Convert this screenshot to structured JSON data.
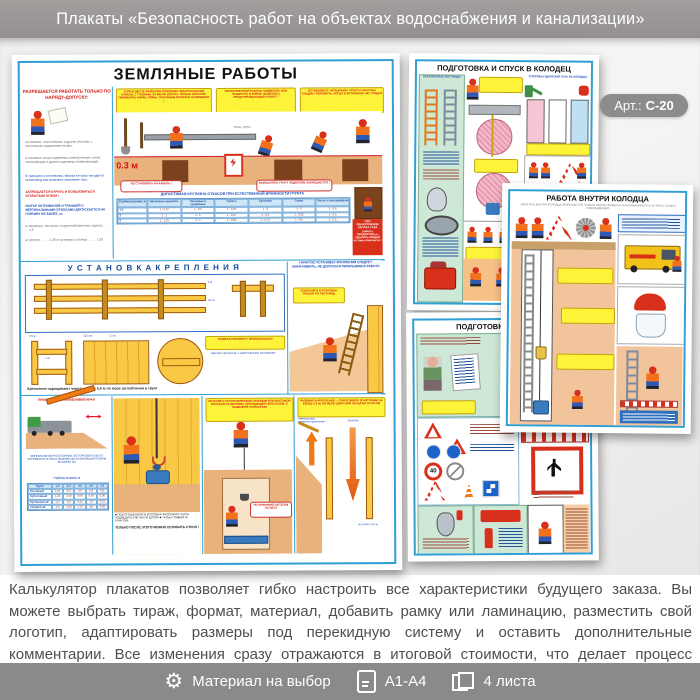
{
  "header": {
    "title": "Плакаты «Безопасность работ на объектах водоснабжения и канализации»"
  },
  "badge": {
    "label": "Арт.:",
    "value": "С-20"
  },
  "main": {
    "title": "ЗЕМЛЯНЫЕ РАБОТЫ",
    "permit_heading": "РАЗРЕШАЕТСЯ РАБОТАТЬ ТОЛЬКО ПО НАРЯДУ-ДОПУСКУ:",
    "permit_items": [
      "на свалках, снегоотвалах и других участках с патогенным заражением почвы;",
      "в охранных зонах подземных электрических сетей, газопроводов и других подземных коммуникаций",
      "В траншеях и котлованах, вблизи которых находится газопровод или возможно скопление газа,",
      "ЗАПРЕЩАЕТСЯ КУРИТЬ И ПОЛЬЗОВАТЬСЯ ОТКРЫТЫМ ОГНЕМ !",
      "РЫТЬЕ КОТЛОВАНОВ И ТРАНШЕЙ С ВЕРТИКАЛЬНЫМИ ОТКОСАМИ ДОПУСКАЕТСЯ НА ГЛУБИНУ НЕ БОЛЕЕ, м:",
      "в насыпных, песчаных и крупнообломочных грунтах . . . . . 1,0",
      "в супесях . . . . . 1,25     в суглинках и глинах . . . . . 1,50"
    ],
    "bubbles": {
      "cable": "ЕСЛИ В МЕСТЕ РАЗРЫТИЯ ПРОЛОЖЕН ЭЛЕКТРИЧЕСКИЙ КАБЕЛЬ, С ГЛУБИНЫ 0,3 МЕТРА КОПАТЬ ТОЛЬКО ЛОПАТОЙ. ПРИМЕНЯТЬ КИРКИ, ЛОМЫ, ОТБОЙНЫЕ МОЛОТКИ ЗАПРЕЩЕНО !",
      "found": "ОБНАРУЖЕННЫЙ КАБЕЛЬ ПОДВЕСИТЬ ИЛИ ЗАЩИТИТЬ В КОРОБ. ВЫВЕСИТЬ ПРЕДУПРЕЖДАЮЩИЙ ПЛАКАТ !",
      "cornices": "ОСТАВШИЕСЯ «КОЗЫРЬКИ» ГРУНТА И ВАЛУНЫ СЛЕДУЕТ ОБРУШИТЬ, КОГДА В КОТЛОВАНЕ НЕТ ЛЮДЕЙ",
      "no_stand": "НЕ СТАНОВИСЬ НА КАБЕЛЬ !",
      "no_loosen": "РАЗРЫХЛЯТЬ ГРУНТ ПОДКОПОМ ЗАПРЕЩАЕТСЯ !"
    },
    "depth_label": "0.3 м",
    "pipe_label": "Рельс, труба",
    "gas_warning": "ПРИ ОБНАРУЖЕНИИ ЗАПАХА ГАЗА работы ПРЕКРАТИТЬ и УДАЛИТЬ ЛЮДЕЙ из зоны опасности !",
    "slope": {
      "super": "ДОПУСТИМАЯ КРУТИЗНА ОТКОСОВ ПРИ ЕСТЕСТВЕННОЙ ВЛАЖНОСТИ ГРУНТА",
      "rowhead": true,
      "head": [
        "Глубина выемки, м",
        "Насыпные неуплотн.",
        "Песчаные и гравийные",
        "Супесь",
        "Суглинок",
        "Глина",
        "Лессы и лессовидные"
      ],
      "rows": [
        [
          "1,5",
          "1 : 0,67",
          "1 : 0,5",
          "1 : 0,25",
          "1 : 0",
          "1 : 0",
          "1 : 0,5"
        ],
        [
          "3",
          "1 : 1",
          "1 : 1",
          "1 : 0,67",
          "1 : 0,5",
          "1 : 0,25",
          "1 : 0,5"
        ],
        [
          "5",
          "1 : 1,25",
          "1 : 1",
          "1 : 0,85",
          "1 : 0,75",
          "1 : 0,5",
          "1 : 0,5"
        ]
      ]
    },
    "bracing": {
      "heading": "У С Т А Н О В К А   К Р Е П Л Е Н И Я",
      "dim_05": "0,5 м",
      "dim_15": "1,5 м",
      "dim_ge15": "≥15 см",
      "dim_1": "1 м",
      "dim_ge5": "≥5 см",
      "spacer_bubble": "СТАВЬТЕ РАСПОРКУ ГОРИЗОНТАЛЬНО",
      "panel_note": "НАЧАТУЮ УСТАНОВКУ КРЕПЛЕНИЯ СЛЕДУЕТ ЗАКАНЧИВАТЬ, НЕ ДОПУСКАЯ ПЕРЕРЫВОВ В РАБОТЕ",
      "ladder_bubble": "ОПУСКАЙСЯ В КОТЛОВАН ТОЛЬКО ПО ЛЕСТНИЦЕ",
      "detail_label": "Щитовое крепление с инвентарными распорками",
      "caption": "Крепление наращивают через каждые 0,5 м по мере заглубления в грунт"
    },
    "crane": {
      "title": "ПРАВИЛЬНО УСТАНАВЛИВАЙ КРАН",
      "note": "МИНИМАЛЬНОЕ РАССТОЯНИЕ ПО ГОРИЗОНТАЛИ ОТ ОСНОВАНИЯ ОТКОСА ВЫЕМКИ ДО БЛИЖАЙШЕЙ ОПОРЫ МАШИНЫ (м)",
      "table": {
        "super": "Глубина выемки, м",
        "rowhead": true,
        "head": [
          "Грунт",
          "1,0",
          "2,0",
          "3,0",
          "4,0",
          "5,0"
        ],
        "rows": [
          [
            "Песчаный",
            "1,50",
            "3,0",
            "4,0",
            "5,0",
            "6,0"
          ],
          [
            "Супесчаный",
            "1,25",
            "2,40",
            "3,60",
            "4,40",
            "5,30"
          ],
          [
            "Суглинистый",
            "1,0",
            "2,0",
            "3,25",
            "4,0",
            "4,75"
          ],
          [
            "Глинистый",
            "1,0",
            "1,50",
            "1,75",
            "3,0",
            "3,50"
          ]
        ]
      }
    },
    "lower": {
      "bullets": "■ ПОД ОПУЩЕННУЮ В КОТЛОВАН ФАСОННУЮ ЧАСТЬ ПОДВЕДИТЕ КЛЕТКИ ИЗ ДОСОК  ■ ТРУБЫ ПОДБЕЙТЕ ГРУНТОМ",
      "strop_caption": "ТОЛЬКО ПОСЛЕ ЭТОГО МОЖНО ОСЛАБИТЬ СТРОП !",
      "kettle_bubble": "КОТЕЛОК С РАСПЛАВЛЕННЫМ СВИНЦОМ ИЛИ МАСТИКОЙ ОПУСКАЙ НА ВЕРЕВКЕ, ПРОХОДЯЩЕЙ ЧЕРЕЗ БЛОК, С ЗАЩЕЛКОЙ КАРАБИНОМ",
      "kettle_note": "НЕ ПРИНИМАЙ КОТЕЛОК НА ВЕСУ",
      "dismantle_note": "РАЗБИРАТЬ КРЕПЛЕНИЕ — СНИЗУ ВВЕРХ (УЧАСТКАМИ НЕ БОЛЕЕ 0,5 м) ПО МЕРЕ ОБРАТНОЙ ЗАСЫПКИ ГРУНТОМ",
      "label_up": "Извлекаемые элементы крепления",
      "label_down": "Засыпка",
      "label_limit": "Не более 0,5 м"
    }
  },
  "posters": {
    "descent": {
      "title": "ПОДГОТОВКА И СПУСК В КОЛОДЕЦ",
      "left_label": "ПЕРЕНОСНЫЕ ЛЕСТНИЦЫ",
      "right_label": "СПОСОБЫ УДАЛЕНИЯ ГАЗА ИЗ КОЛОДЦА"
    },
    "inside": {
      "title": "РАБОТА ВНУТРИ КОЛОДЦА",
      "subtitle": "РАБОТАТЬ ВНУТРИ КОЛОДЦА РАЗРЕШАЕТСЯ ТОЛЬКО ПОСЛЕ ПРОВЕРКИ ЗАГАЗОВАННОСТИ И В ПРИСУТСТВИИ НАБЛЮДАЮЩИХ"
    },
    "prep": {
      "title_visible": "ПОДГОТОВКА К С",
      "sign40": "40"
    }
  },
  "description": {
    "text": "Калькулятор плакатов позволяет гибко настроить все характеристики будущего заказа. Вы можете выбрать тираж, формат, материал, добавить рамку или ламинацию, разместить свой логотип, адаптировать размеры под перекидную систему и оставить дополнительные комментарии. Все изменения сразу отражаются в итоговой стоимости, что делает процесс заказа быстрым и прозрачным"
  },
  "footer": {
    "gear_glyph": "⚙",
    "items": [
      {
        "label": "Материал на выбор"
      },
      {
        "label": "А1-А4"
      },
      {
        "label": "4 листа"
      }
    ]
  }
}
